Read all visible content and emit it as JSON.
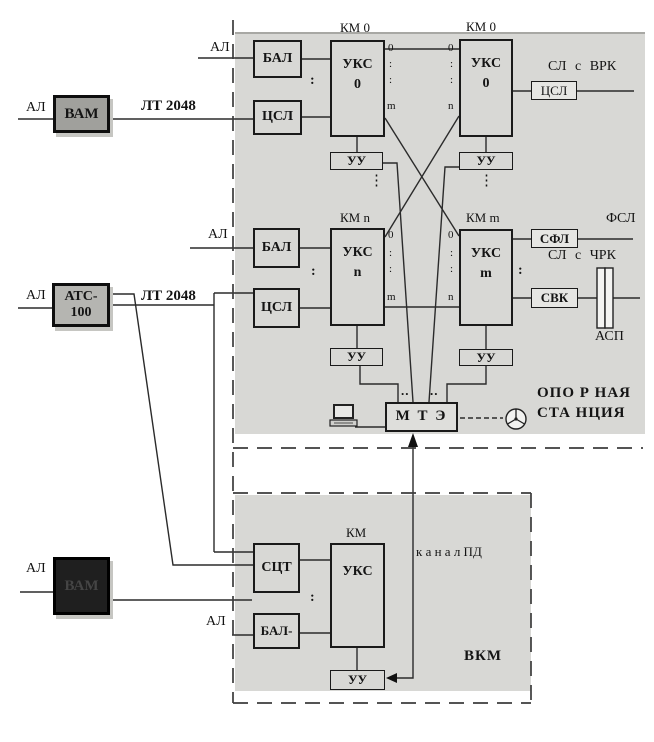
{
  "colors": {
    "station_bg": "#d8d8d5",
    "line": "#2b2b2b",
    "dash_border": "#3c3c3c"
  },
  "labels": {
    "al": "АЛ",
    "lt2048": "ЛТ 2048",
    "km0": "КМ 0",
    "kmn": "КМ n",
    "kmm": "КМ m",
    "km": "КМ",
    "sl_vrk": "СЛ с ВРК",
    "fsl": "ФСЛ",
    "sl_chrk": "СЛ с ЧРК",
    "asp": "АСП",
    "kanal_pd": "к а н а л  ПД",
    "vkm": "ВКМ",
    "station1": "ОПО Р НАЯ",
    "station2": "СТА НЦИЯ",
    "colon": ":",
    "vdots": "⋮",
    "hdots": ".."
  },
  "ports": {
    "p0": "0",
    "pm": "m",
    "pn": "n"
  },
  "blocks": {
    "vam": "ВАМ",
    "ats1": "АТС-",
    "ats2": "100",
    "bal": "БАЛ",
    "csl": "ЦСЛ",
    "uks": "УКС",
    "uu": "УУ",
    "mte": "М Т Э",
    "sfl": "СФЛ",
    "svk": "СВК",
    "sct": "СЦТ",
    "bal_minus": "БАЛ-"
  }
}
